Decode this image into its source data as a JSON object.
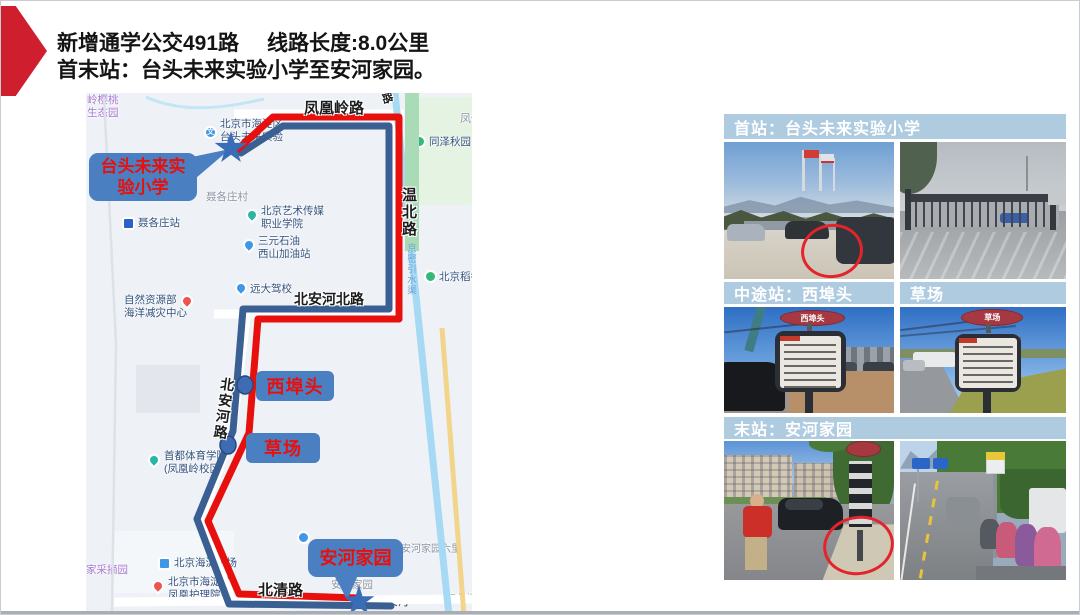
{
  "slide": {
    "title_route": "新增通学公交491路",
    "title_length": "线路长度:8.0公里",
    "title_stations": "首末站：台头未来实验小学至安河家园。"
  },
  "map": {
    "road_labels": {
      "top": "凤凰岭路",
      "top_fragment": "路",
      "right_fragment": "凤仙",
      "wenbei": "温北路",
      "canal": "京密引水渠",
      "beianhe_north": "北安河北路",
      "beianhe": "北安河路",
      "beiqing": "北清路"
    },
    "pois": [
      {
        "line1": "岭樱桃",
        "line2": "生态园"
      },
      {
        "line1": "北京市海淀区",
        "line2": "台头未来实验"
      },
      {
        "line1": "聂各庄村"
      },
      {
        "line1": "聂各庄站"
      },
      {
        "line1": "北京艺术传媒",
        "line2": "职业学院"
      },
      {
        "line1": "三元石油",
        "line2": "西山加油站"
      },
      {
        "line1": "同泽秋园"
      },
      {
        "line1": "北京稻香村"
      },
      {
        "line1": "远大驾校"
      },
      {
        "line1": "自然资源部",
        "line2": "海洋减灾中心"
      },
      {
        "line1": "首都体育学院",
        "line2": "(凤凰岭校区)"
      },
      {
        "line1": "家采摘园"
      },
      {
        "line1": "北京海淀机场"
      },
      {
        "line1": "北京市海淀区",
        "line2": "凤凰护理院"
      },
      {
        "line1": "安河家园"
      },
      {
        "line1": "安河家园六里"
      },
      {
        "line1": "北安河"
      },
      {
        "line1": "双北桥"
      }
    ],
    "stop_labels": {
      "xibutou": "西埠头",
      "caochang": "草场"
    },
    "callout_start_line1": "台头未来实",
    "callout_start_line2": "验小学",
    "callout_end": "安河家园"
  },
  "photos": {
    "caption_first": "首站：台头未来实验小学",
    "caption_mid": "中途站：西埠头",
    "caption_mid_right": "草场",
    "caption_last": "末站：安河家园",
    "sign_xibutou": "西埠头",
    "sign_caochang": "草场"
  },
  "colors": {
    "route_red": "#e8100c",
    "route_blue": "#3a5f92",
    "callout_blue": "#4a7fc1",
    "stop_text_red": "#e8100c",
    "caption_bar_blue": "#aecbe0",
    "title_arrow_red": "#cf1f2e"
  }
}
